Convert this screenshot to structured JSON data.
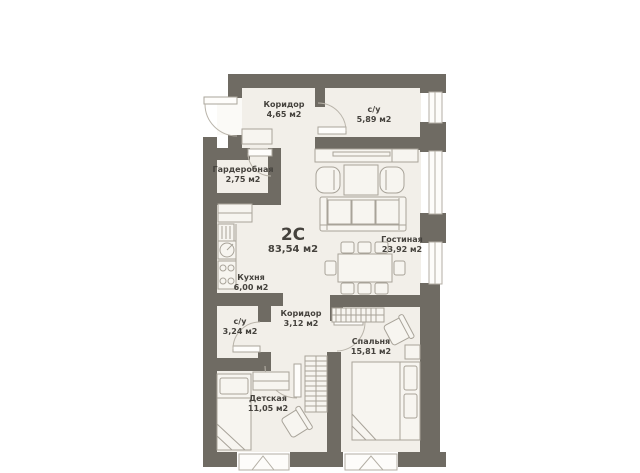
{
  "plan": {
    "type_label": "2С",
    "total_area": "83,54 м2",
    "rooms": [
      {
        "name": "Коридор",
        "area": "4,65 м2"
      },
      {
        "name": "с/у",
        "area": "5,89 м2"
      },
      {
        "name": "Гардеробная",
        "area": "2,75 м2"
      },
      {
        "name": "Кухня",
        "area": "6,00 м2"
      },
      {
        "name": "Гостиная",
        "area": "23,92 м2"
      },
      {
        "name": "с/у",
        "area": "3,24 м2"
      },
      {
        "name": "Коридор",
        "area": "3,12 м2"
      },
      {
        "name": "Спальня",
        "area": "15,81 м2"
      },
      {
        "name": "Детская",
        "area": "11,05 м2"
      }
    ],
    "colors": {
      "wall": "#6f6b63",
      "floor": "#f2efe9",
      "outline": "#a8a399",
      "text": "#45423d",
      "background": "#ffffff"
    }
  }
}
